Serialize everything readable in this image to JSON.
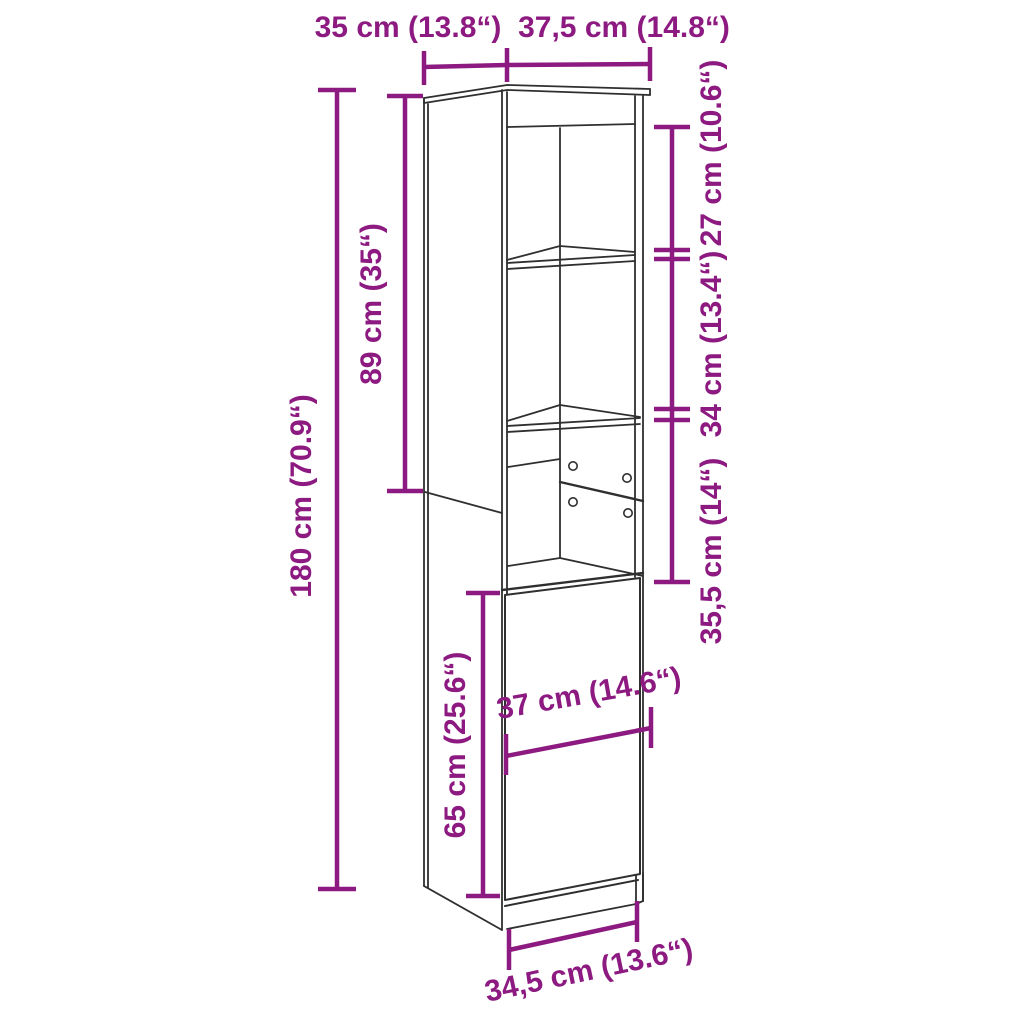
{
  "diagram": {
    "accent_color": "#8c1a80",
    "line_color": "#2f2f2f",
    "background_color": "#ffffff",
    "subject": "tall-cabinet-dimension-drawing",
    "labels": {
      "top_depth": "35 cm (13.8“)",
      "top_width": "37,5 cm (14.8“)",
      "total_height": "180 cm (70.9“)",
      "upper_section_height": "89 cm (35“)",
      "compartment_1_height": "27 cm (10.6“)",
      "compartment_2_height": "34 cm (13.4“)",
      "compartment_3_height": "35,5 cm (14“)",
      "inner_width": "37 cm (14.6“)",
      "door_height": "65 cm (25.6“)",
      "base_width": "34,5 cm (13.6“)"
    }
  }
}
